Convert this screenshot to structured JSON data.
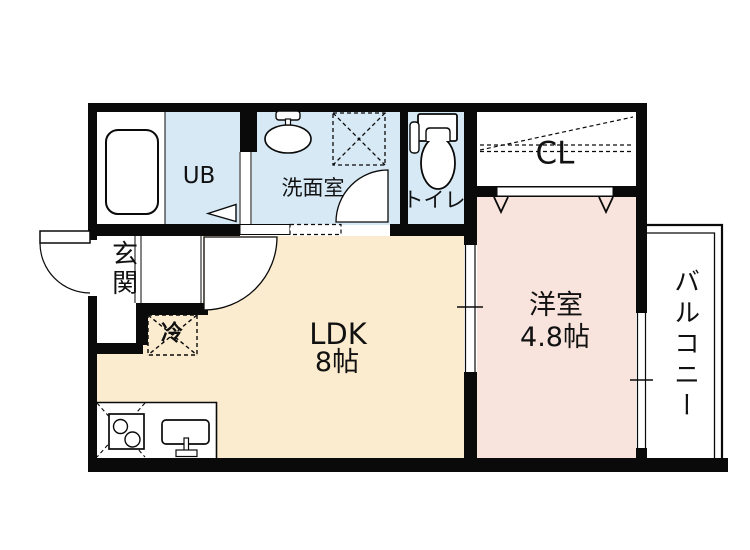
{
  "floor_plan": {
    "rooms": {
      "unit_bath": {
        "label": "UB"
      },
      "washroom": {
        "label": "洗面室"
      },
      "toilet": {
        "label": "トイレ"
      },
      "closet": {
        "label": "CL"
      },
      "entrance": {
        "label": "玄関"
      },
      "ldk": {
        "label": "LDK",
        "size": "8帖"
      },
      "western_room": {
        "label": "洋室",
        "size": "4.8帖"
      },
      "balcony": {
        "label": "バルコニー"
      }
    },
    "fixtures": {
      "refrigerator": {
        "label": "冷"
      }
    },
    "colors": {
      "wall": "#0a0a0a",
      "wet_area_floor": "#d6e9f5",
      "ldk_floor": "#fbeccf",
      "western_room_floor": "#f8e3dd",
      "fixture_white": "#ffffff",
      "background": "#ffffff"
    }
  }
}
